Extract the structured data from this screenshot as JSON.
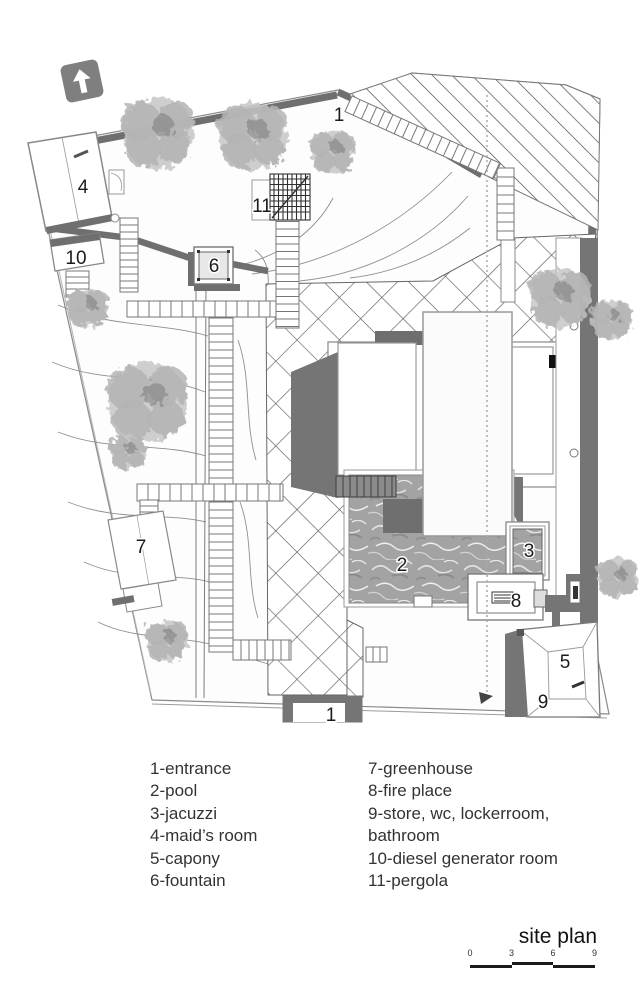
{
  "title": "site plan",
  "north_arrow": {
    "meaning": "north direction"
  },
  "plan_labels": [
    {
      "text": "1",
      "x": 339,
      "y": 121
    },
    {
      "text": "4",
      "x": 83,
      "y": 193
    },
    {
      "text": "11",
      "x": 262,
      "y": 212
    },
    {
      "text": "10",
      "x": 76,
      "y": 264
    },
    {
      "text": "6",
      "x": 214,
      "y": 272
    },
    {
      "text": "7",
      "x": 141,
      "y": 553
    },
    {
      "text": "2",
      "x": 402,
      "y": 571
    },
    {
      "text": "3",
      "x": 529,
      "y": 557
    },
    {
      "text": "8",
      "x": 516,
      "y": 607
    },
    {
      "text": "5",
      "x": 565,
      "y": 668
    },
    {
      "text": "9",
      "x": 543,
      "y": 708
    },
    {
      "text": "1",
      "x": 331,
      "y": 721
    }
  ],
  "legend": {
    "columns": [
      {
        "items": [
          "1-entrance",
          "2-pool",
          "3-jacuzzi",
          "4-maid’s room",
          "5-capony",
          "6-fountain"
        ]
      },
      {
        "items": [
          "7-greenhouse",
          "8-fire place",
          "9-store, wc, lockerroom, bathroom",
          "10-diesel generator room",
          "11-pergola"
        ]
      }
    ]
  },
  "scale_bar": {
    "ticks": [
      "0",
      "3",
      "6",
      "9"
    ]
  }
}
